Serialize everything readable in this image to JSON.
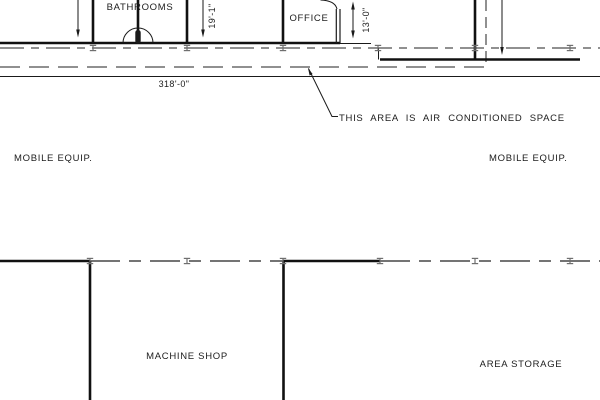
{
  "drawing": {
    "rooms": {
      "bathrooms": "BATHROOMS",
      "office": "OFFICE",
      "mobile_equip_left": "MOBILE EQUIP.",
      "mobile_equip_right": "MOBILE EQUIP.",
      "machine_shop": "MACHINE SHOP",
      "area_storage": "AREA STORAGE"
    },
    "dimensions": {
      "overall_length": "318'-0\"",
      "bay_height": "19'-1\"",
      "office_height": "13'-0\""
    },
    "notes": {
      "air_conditioned": "THIS AREA IS AIR CONDITIONED SPACE"
    },
    "colors": {
      "line": "#111111",
      "tick": "#6f6f6f",
      "background": "#ffffff"
    }
  }
}
